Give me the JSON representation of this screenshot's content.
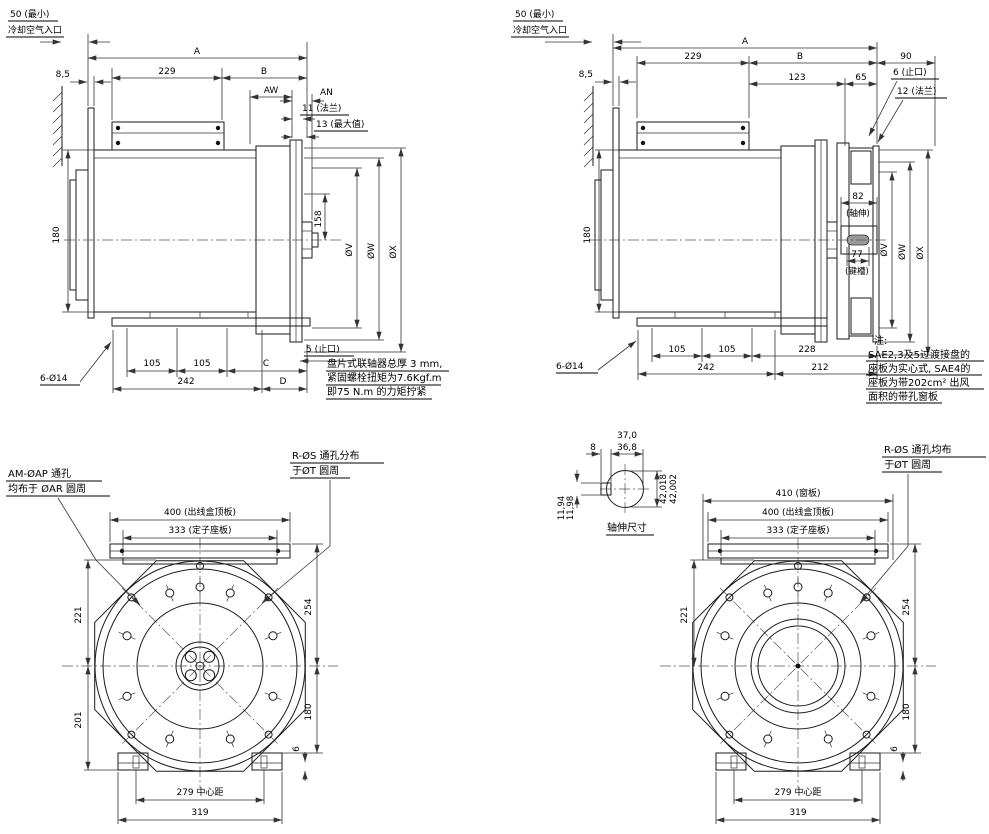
{
  "drawing": {
    "tl": {
      "min_air": "50 (最小)",
      "air_inlet": "冷却空气入口",
      "d85": "8,5",
      "A": "A",
      "d229": "229",
      "B": "B",
      "AW": "AW",
      "AN": "AN",
      "flange11": "11 (法兰)",
      "max13": "13 (最大值)",
      "d180": "180",
      "d158": "158",
      "dV": "ØV",
      "dW": "ØW",
      "dX": "ØX",
      "spigot5": "5 (止口)",
      "d105a": "105",
      "d105b": "105",
      "C": "C",
      "d242": "242",
      "D": "D",
      "holes": "6-Ø14",
      "note1": "盘片式联轴器总厚 3 mm,",
      "note2": "紧固螺栓扭矩为7.6Kgf.m",
      "note3": "即75 N.m 的力矩拧紧"
    },
    "tr": {
      "min_air": "50 (最小)",
      "air_inlet": "冷却空气入口",
      "d85": "8,5",
      "A": "A",
      "d229": "229",
      "B": "B",
      "d123": "123",
      "d65": "65",
      "d90": "90",
      "spigot6": "6 (止口)",
      "flange12": "12 (法兰)",
      "d180": "180",
      "d82": "82",
      "shaft_ext": "(轴伸)",
      "d77": "77",
      "keyway": "(键槽)",
      "dV": "ØV",
      "dW": "ØW",
      "dX": "ØX",
      "d105a": "105",
      "d105b": "105",
      "d228": "228",
      "d242": "242",
      "d212": "212",
      "holes": "6-Ø14",
      "note0": "注:",
      "note1": "SAE2,3及5过渡接盘的",
      "note2": "座板为实心式, SAE4的",
      "note3": "座板为带202cm² 出风",
      "note4": "面积的带孔窗板"
    },
    "bl": {
      "am1": "AM-ØAP 通孔",
      "am2": "均布于 ØAR 圆周",
      "rs1": "R-ØS 通孔分布",
      "rs2": "于ØT 圆周",
      "d400": "400 (出线盒顶板)",
      "d333": "333 (定子座板)",
      "d221": "221",
      "d201": "201",
      "d254": "254",
      "d180": "180",
      "d6": "6",
      "d279": "279 中心距",
      "d319": "319"
    },
    "br": {
      "rs1": "R-ØS 通孔均布",
      "rs2": "于ØT 圆周",
      "d410": "410 (窗板)",
      "d400": "400 (出线盒顶板)",
      "d333": "333 (定子座板)",
      "d221": "221",
      "d254": "254",
      "d180": "180",
      "d6": "6",
      "d279": "279 中心距",
      "d319": "319",
      "shaft": {
        "d370": "37,0",
        "d368": "36,8",
        "d8": "8",
        "dia_hi": "42,018",
        "dia_lo": "42,002",
        "key_hi": "11,94",
        "key_lo": "11,98",
        "caption": "轴伸尺寸"
      }
    }
  }
}
